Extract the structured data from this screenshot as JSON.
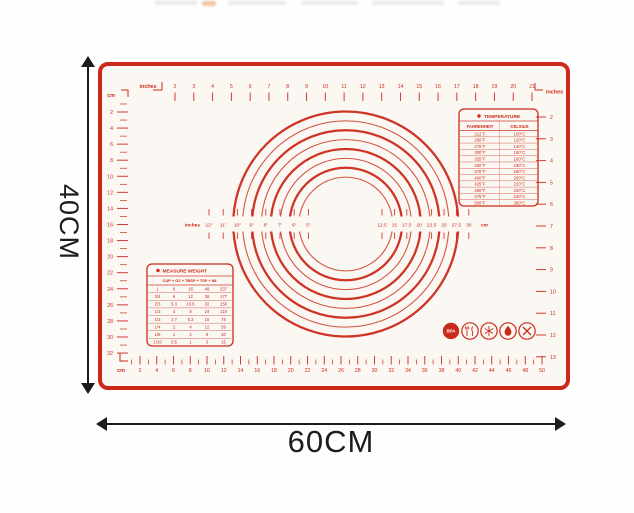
{
  "page": {
    "height_label": "40CM",
    "width_label": "60CM"
  },
  "mat": {
    "colors": {
      "red": "#cb2a1a",
      "mat_surface": "#fbf8f3",
      "arrow_black": "#1c1c1c"
    },
    "rulers": {
      "top": {
        "unit": "inches",
        "numbers": [
          2,
          3,
          4,
          5,
          6,
          7,
          8,
          9,
          10,
          11,
          12,
          13,
          14,
          15,
          16,
          17,
          18,
          19,
          20,
          21
        ]
      },
      "left": {
        "unit": "cm",
        "numbers": [
          2,
          4,
          6,
          8,
          10,
          12,
          14,
          16,
          18,
          20,
          22,
          24,
          26,
          28,
          30,
          32
        ]
      },
      "right": {
        "unit": "inches",
        "numbers": [
          2,
          3,
          4,
          5,
          6,
          7,
          8,
          9,
          10,
          11,
          12,
          13
        ]
      },
      "bottom": {
        "unit": "cm",
        "numbers": [
          2,
          4,
          6,
          8,
          10,
          12,
          14,
          16,
          18,
          20,
          22,
          24,
          26,
          28,
          30,
          32,
          34,
          36,
          38,
          40,
          42,
          44,
          46,
          48,
          50
        ]
      }
    },
    "circle_gauge": {
      "left_unit": "inches",
      "right_unit": "cm",
      "inch_labels": [
        "12\"",
        "11\"",
        "10\"",
        "9\"",
        "8\"",
        "7\"",
        "6\"",
        "5\""
      ],
      "cm_labels": [
        "12.5",
        "15",
        "17.5",
        "20",
        "22.5",
        "25",
        "27.5",
        "30"
      ],
      "diameters_cm": [
        12.5,
        15,
        17.5,
        20,
        22.5,
        25,
        27.5,
        30
      ]
    },
    "temperature_table": {
      "title": "TEMPERATURE",
      "columns": [
        "FAHRENHEIT",
        "CELSIUS"
      ],
      "rows": [
        [
          "212°F",
          "100°C"
        ],
        [
          "250°F",
          "120°C"
        ],
        [
          "275°F",
          "140°C"
        ],
        [
          "300°F",
          "150°C"
        ],
        [
          "325°F",
          "160°C"
        ],
        [
          "350°F",
          "180°C"
        ],
        [
          "375°F",
          "190°C"
        ],
        [
          "400°F",
          "200°C"
        ],
        [
          "425°F",
          "220°C"
        ],
        [
          "450°F",
          "230°C"
        ],
        [
          "475°F",
          "240°C"
        ],
        [
          "500°F",
          "260°C"
        ]
      ]
    },
    "measure_table": {
      "title": "MEASURE WEIGHT",
      "columns": [
        "CUP",
        "OZ",
        "TBSP",
        "TSP",
        "ML"
      ],
      "rows": [
        [
          "1",
          "8",
          "16",
          "48",
          "237"
        ],
        [
          "3/4",
          "6",
          "12",
          "36",
          "177"
        ],
        [
          "2/3",
          "5.3",
          "10.6",
          "32",
          "158"
        ],
        [
          "1/2",
          "4",
          "8",
          "24",
          "118"
        ],
        [
          "1/3",
          "2.7",
          "5.3",
          "16",
          "79"
        ],
        [
          "1/4",
          "2",
          "4",
          "12",
          "59"
        ],
        [
          "1/8",
          "1",
          "2",
          "6",
          "30"
        ],
        [
          "1/16",
          "0.5",
          "1",
          "3",
          "15"
        ]
      ]
    },
    "badges": [
      {
        "name": "bpa-free",
        "label": "BPA"
      },
      {
        "name": "food-safe",
        "label": ""
      },
      {
        "name": "freezer-safe",
        "label": ""
      },
      {
        "name": "heat-resistant",
        "label": ""
      },
      {
        "name": "no-cutting",
        "label": ""
      }
    ]
  }
}
